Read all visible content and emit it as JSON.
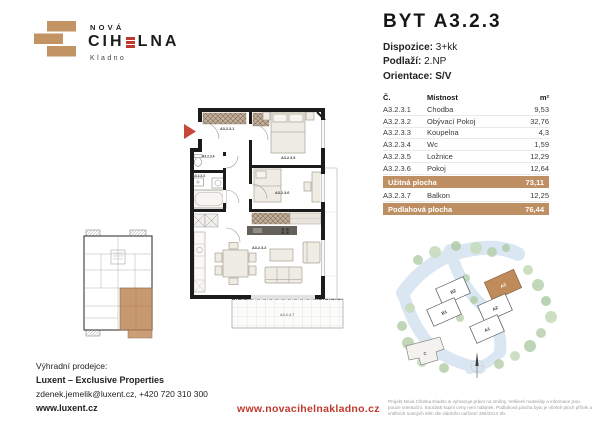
{
  "colors": {
    "tan": "#BE8F63",
    "red": "#C0392E",
    "brick": "#C29363",
    "road_blue": "#DAE7F3",
    "tree_green": "#AECBA4"
  },
  "logo": {
    "top": "NOVÁ",
    "name_pre": "CIH",
    "name_post": "LNA",
    "city": "Kladno"
  },
  "header": {
    "title": "BYT A3.2.3",
    "specs": [
      {
        "label": "Dispozice:",
        "value": "3+kk"
      },
      {
        "label": "Podlaží:",
        "value": "2.NP"
      },
      {
        "label": "Orientace:",
        "value": "S/V"
      }
    ]
  },
  "table": {
    "col_no": "Č.",
    "col_room": "Místnost",
    "col_area": "m²",
    "rows": [
      {
        "no": "A3.2.3.1",
        "room": "Chodba",
        "area": "9,53"
      },
      {
        "no": "A3.2.3.2",
        "room": "Obývací Pokoj",
        "area": "32,76"
      },
      {
        "no": "A3.2.3.3",
        "room": "Koupelna",
        "area": "4,3"
      },
      {
        "no": "A3.2.3.4",
        "room": "Wc",
        "area": "1,59"
      },
      {
        "no": "A3.2.3.5",
        "room": "Ložnice",
        "area": "12,29"
      },
      {
        "no": "A3.2.3.6",
        "room": "Pokoj",
        "area": "12,64"
      }
    ],
    "uzitna": {
      "label": "Užitná plocha",
      "value": "73,11"
    },
    "balkon": {
      "no": "A3.2.3.7",
      "room": "Balkon",
      "area": "12,25"
    },
    "podlahova": {
      "label": "Podlahová plocha",
      "value": "76,44"
    }
  },
  "floorplan": {
    "labels": {
      "chodba": "A3.2.3.1",
      "obyvaci": "A3.2.3.2",
      "koupelna": "A3.2.3.3",
      "wc": "A3.2.3.4",
      "loznice": "A3.2.3.5",
      "pokoj": "A3.2.3.6",
      "balkon": "A3.2.3.7"
    }
  },
  "siteplan": {
    "buildings": [
      "B2",
      "B1",
      "A3",
      "A2",
      "A1",
      "C"
    ],
    "highlighted": "A3"
  },
  "contact": {
    "intro": "Výhradní prodejce:",
    "company": "Luxent – Exclusive Properties",
    "email_phone": "zdenek.jemelik@luxent.cz, +420 720 310 300",
    "web": "www.luxent.cz"
  },
  "footer": {
    "url": "www.novacihelnakladno.cz",
    "disclaimer": "Projekt Nová Cihelna Kladno si vyhrazuje právo na změny. Veškeré materiály a informace jsou pouze orientační. Součástí kupní ceny není nábytek. Podlahová plocha bytu je včetně ploch příček a vnitřních nosných stěn dle vládního nařízení 366/2013 Sb."
  }
}
